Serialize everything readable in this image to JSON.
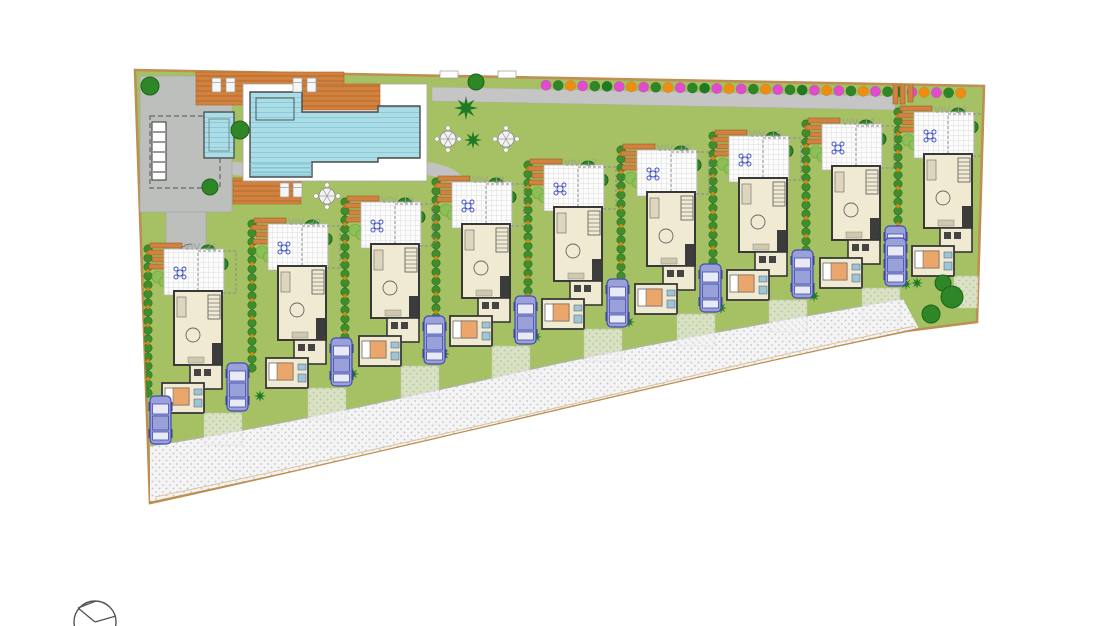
{
  "plan_title": "Residential site plan with communal pool and 9 villas",
  "villas": [
    {
      "id": "viv-13",
      "label": "VIV. 13",
      "x": 898,
      "y": 100,
      "car_side": "left"
    },
    {
      "id": "viv-14",
      "label": "VIV. 14",
      "x": 806,
      "y": 112,
      "car_side": "right"
    },
    {
      "id": "viv-15",
      "label": "VIV. 15",
      "x": 713,
      "y": 124,
      "car_side": "right"
    },
    {
      "id": "viv-16",
      "label": "VIV. 16",
      "x": 621,
      "y": 138,
      "car_side": "right"
    },
    {
      "id": "viv-17",
      "label": "VIV. 17",
      "x": 528,
      "y": 153,
      "car_side": "right"
    },
    {
      "id": "viv-18",
      "label": "VIV. 18",
      "x": 436,
      "y": 170,
      "car_side": "right"
    },
    {
      "id": "viv-19",
      "label": "VIV. 19",
      "x": 345,
      "y": 190,
      "car_side": "right"
    },
    {
      "id": "viv-20",
      "label": "VIV. 20",
      "x": 252,
      "y": 212,
      "car_side": "right"
    },
    {
      "id": "viv-21",
      "label": "VIV. 21",
      "x": 148,
      "y": 237,
      "car_side": "right"
    }
  ],
  "palette": {
    "lawn": "#a6c164",
    "boundary": "#bd8f52",
    "road_bg": "#f4f4f5",
    "road_dot": "#c3c3ca",
    "sidewalk": "#c5c5c5",
    "paving": "#bcbfbc",
    "deck": "#d2823e",
    "deck_line": "#a9652a",
    "water": "#aadde6",
    "water_line": "#8cc9d6",
    "pool_edge": "#4a4a4a",
    "house_fill": "#f0ead2",
    "house_wall": "#383838",
    "terrace_tile": "#fcfcfc",
    "terrace_line": "#d2d2d2",
    "hedge_green": "#3f8d2c",
    "hedge_berry": "#e1820f",
    "tree_green": "#2e8626",
    "tree_edge": "#1d6419",
    "palm_green": "#1f7a23",
    "bush_light": "#8cbf55",
    "bush_magenta": "#e04ccb",
    "bush_orange": "#ef8d12",
    "car_body": "#99a1d8",
    "car_line": "#424bb0",
    "label_text": "#98a091",
    "bed_blanket": "#eba76b",
    "bath_fixture": "#9cc6d4",
    "furniture_blue": "#3d4fc0"
  },
  "icons": {
    "north_arrow": "compass-circle",
    "parked_car": "car-top-view",
    "sun_lounger": "sun-lounger",
    "parasol": "parasol-table",
    "palm": "palm-tree",
    "tree": "round-tree"
  }
}
